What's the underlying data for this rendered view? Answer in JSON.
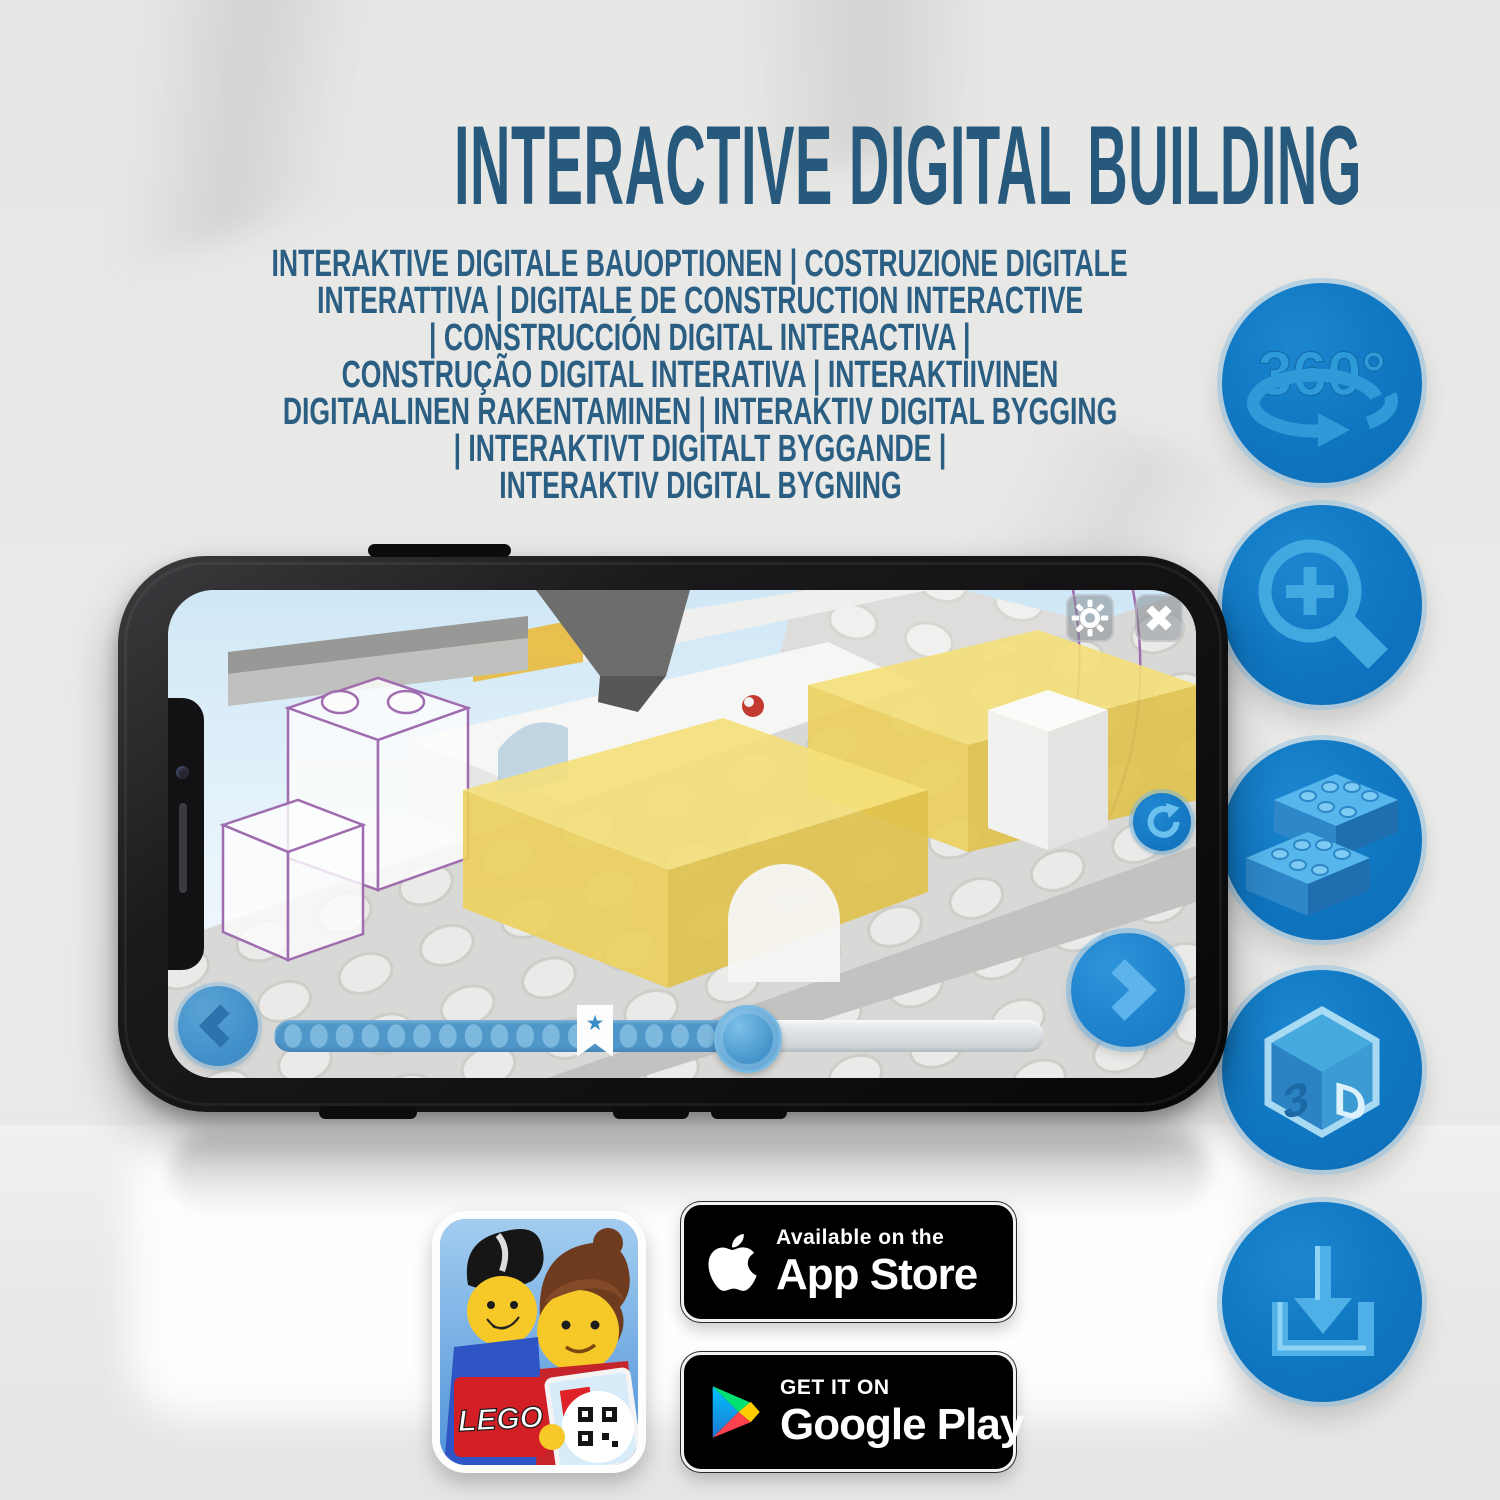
{
  "title": "INTERACTIVE DIGITAL BUILDING",
  "subtitle_lines": [
    "INTERAKTIVE DIGITALE BAUOPTIONEN | COSTRUZIONE DIGITALE",
    "INTERATTIVA | DIGITALE DE CONSTRUCTION INTERACTIVE",
    "| CONSTRUCCIÓN DIGITAL INTERACTIVA |",
    "CONSTRUÇÃO DIGITAL INTERATIVA | INTERAKTIIVINEN",
    "DIGITAALINEN RAKENTAMINEN | INTERAKTIV DIGITAL BYGGING",
    "| INTERAKTIVT DIGITALT BYGGANDE |",
    "INTERAKTIV DIGITAL BYGNING"
  ],
  "colors": {
    "title_blue": "#27597d",
    "feature_circle_blue": "#0f76c1",
    "feature_glyph_blue": "#41a8e0",
    "app_accent_blue": "#4a90c4",
    "highlight_yellow": "#f5e07a"
  },
  "feature_icons": [
    {
      "name": "rotate-360",
      "label": "360°"
    },
    {
      "name": "zoom-in",
      "label": ""
    },
    {
      "name": "brick-building-steps",
      "label": ""
    },
    {
      "name": "3d-view",
      "letters": [
        "3",
        "D"
      ]
    },
    {
      "name": "download",
      "label": ""
    }
  ],
  "phone": {
    "progress_star": "★"
  },
  "badges": {
    "app_store": {
      "line1": "Available on the",
      "line2": "App Store"
    },
    "google_play": {
      "line1": "GET IT ON",
      "line2": "Google Play"
    },
    "lego_tile": "LEGO"
  }
}
